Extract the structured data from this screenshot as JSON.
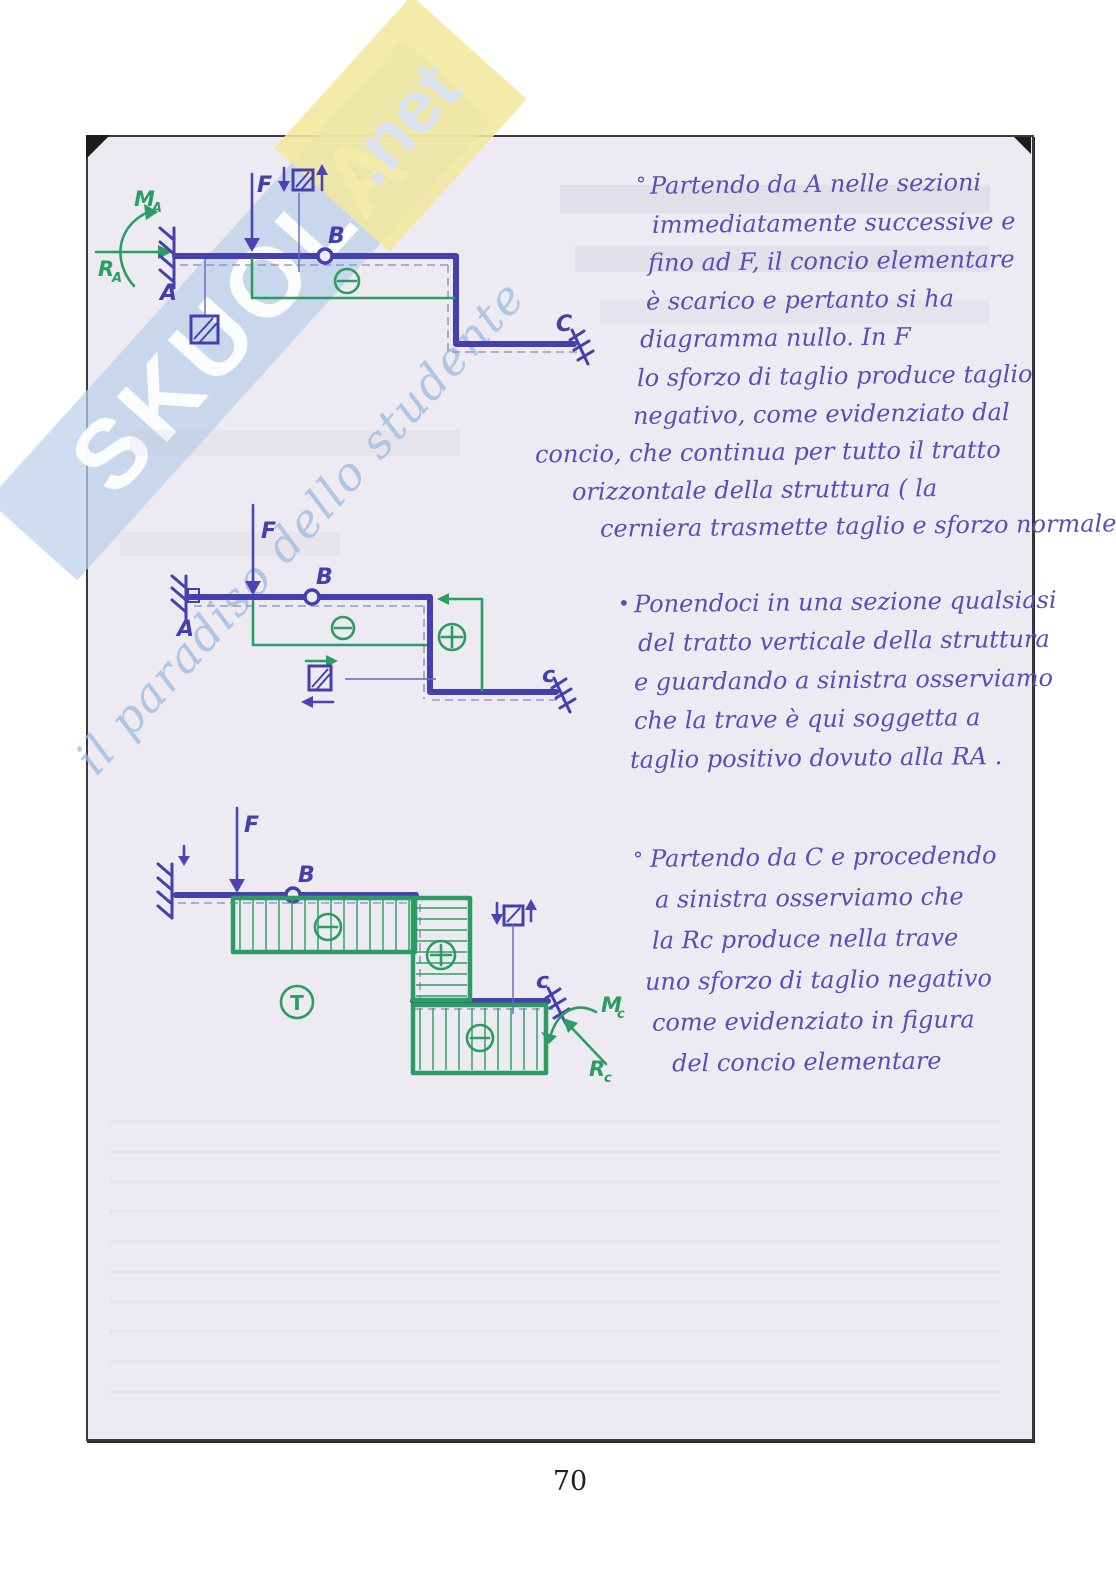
{
  "page_number": "70",
  "watermark": {
    "brand": "SKUOLA",
    "tld": ".net",
    "tagline": "il paradiso dello studente",
    "band_blue": "#bbd0e9",
    "band_yellow": "#f3e89e"
  },
  "colors": {
    "pen_blue": "#4540ae",
    "pen_green": "#2b9d62",
    "paper": "#edeaf2"
  },
  "diagram1": {
    "force_label": "F",
    "point_a": "A",
    "point_b": "B",
    "point_c": "C",
    "moment_label": "M",
    "moment_sub": "A",
    "reaction_label": "R",
    "reaction_sub": "A"
  },
  "diagram2": {
    "force_label": "F",
    "point_a": "A",
    "point_b": "B",
    "point_c": "c"
  },
  "diagram3": {
    "force_label": "F",
    "point_b": "B",
    "point_c": "c",
    "shear_diagram_label": "T",
    "moment_label": "M",
    "moment_sub": "c",
    "reaction_label": "R",
    "reaction_sub": "c"
  },
  "notes": {
    "paragraphs": [
      {
        "bullet": "°",
        "lines": [
          "Partendo da A nelle sezioni",
          "immediatamente successive e",
          "fino ad F, il concio elementare",
          "è scarico e pertanto si ha",
          "diagramma nullo. In F",
          "lo sforzo di taglio produce taglio",
          "negativo, come evidenziato dal",
          "concio, che continua per tutto il tratto",
          "orizzontale della struttura ( la",
          "cerniera trasmette taglio e sforzo normale)"
        ]
      },
      {
        "bullet": "•",
        "lines": [
          "Ponendoci in una sezione qualsiasi",
          "del tratto verticale della struttura",
          "e guardando a sinistra osserviamo",
          "che la trave è qui soggetta a",
          "taglio positivo dovuto alla RA ."
        ]
      },
      {
        "bullet": "°",
        "lines": [
          "Partendo da C e procedendo",
          "a sinistra osserviamo che",
          "la Rc produce nella trave",
          "uno sforzo di taglio negativo",
          "come evidenziato in figura",
          "del concio elementare"
        ]
      }
    ]
  }
}
